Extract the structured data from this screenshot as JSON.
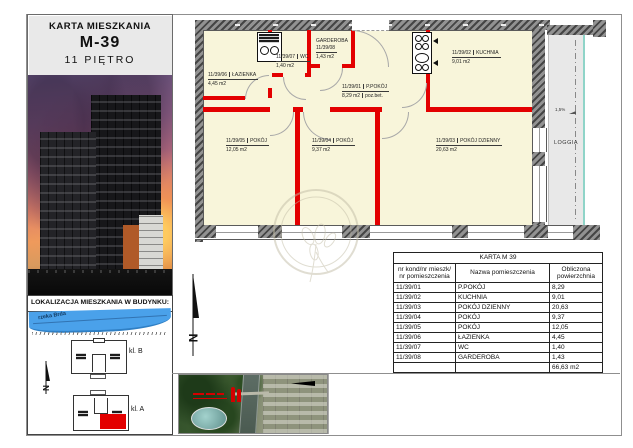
{
  "card": {
    "title": "KARTA MIESZKANIA",
    "unit": "M-39",
    "floor": "11 PIĘTRO"
  },
  "floor_plan": {
    "rooms": [
      {
        "id": "11/39/01",
        "name": "P.POKÓJ",
        "area": "8,29 m2",
        "note": "poz.bet."
      },
      {
        "id": "11/39/02",
        "name": "KUCHNIA",
        "area": "9,01 m2"
      },
      {
        "id": "11/39/03",
        "name": "POKÓJ DZIENNY",
        "area": "20,63 m2"
      },
      {
        "id": "11/39/04",
        "name": "POKÓJ",
        "area": "9,37 m2"
      },
      {
        "id": "11/39/05",
        "name": "POKÓJ",
        "area": "12,05 m2"
      },
      {
        "id": "11/39/06",
        "name": "ŁAZIENKA",
        "area": "4,45 m2"
      },
      {
        "id": "11/39/07",
        "name": "WC",
        "area": "1,40 m2"
      },
      {
        "id": "11/39/08",
        "name": "GARDEROBA",
        "area": "1,43 m2"
      }
    ],
    "loggia_label": "LOGGIA",
    "slope_label": "1,5%"
  },
  "location": {
    "title": "LOKALIZACJA MIESZKANIA W BUDYNKU:",
    "river_label": "rzeka Brda",
    "stair_b_label": "kl. B",
    "stair_a_label": "kl. A"
  },
  "table": {
    "title": "KARTA M 39",
    "columns": [
      "nr kond/nr mieszk/\nnr pomieszczenia",
      "Nazwa pomieszczenia",
      "Obliczona\npowierzchnia"
    ],
    "rows": [
      [
        "11/39/01",
        "P.POKÓJ",
        "8,29"
      ],
      [
        "11/39/02",
        "KUCHNIA",
        "9,01"
      ],
      [
        "11/39/03",
        "POKÓJ DZIENNY",
        "20,63"
      ],
      [
        "11/39/04",
        "POKÓJ",
        "9,37"
      ],
      [
        "11/39/05",
        "POKÓJ",
        "12,05"
      ],
      [
        "11/39/06",
        "ŁAZIENKA",
        "4,45"
      ],
      [
        "11/39/07",
        "WC",
        "1,40"
      ],
      [
        "11/39/08",
        "GARDEROBA",
        "1,43"
      ]
    ],
    "total": "66,63 m2"
  },
  "colors": {
    "wall_red": "#e30000",
    "room_fill": "#f8f5da",
    "wall_gray": "#7b7b7b",
    "loggia_teal": "#8fd4c8",
    "river_blue": "#4aa1ea",
    "marker_red": "#d40000"
  }
}
